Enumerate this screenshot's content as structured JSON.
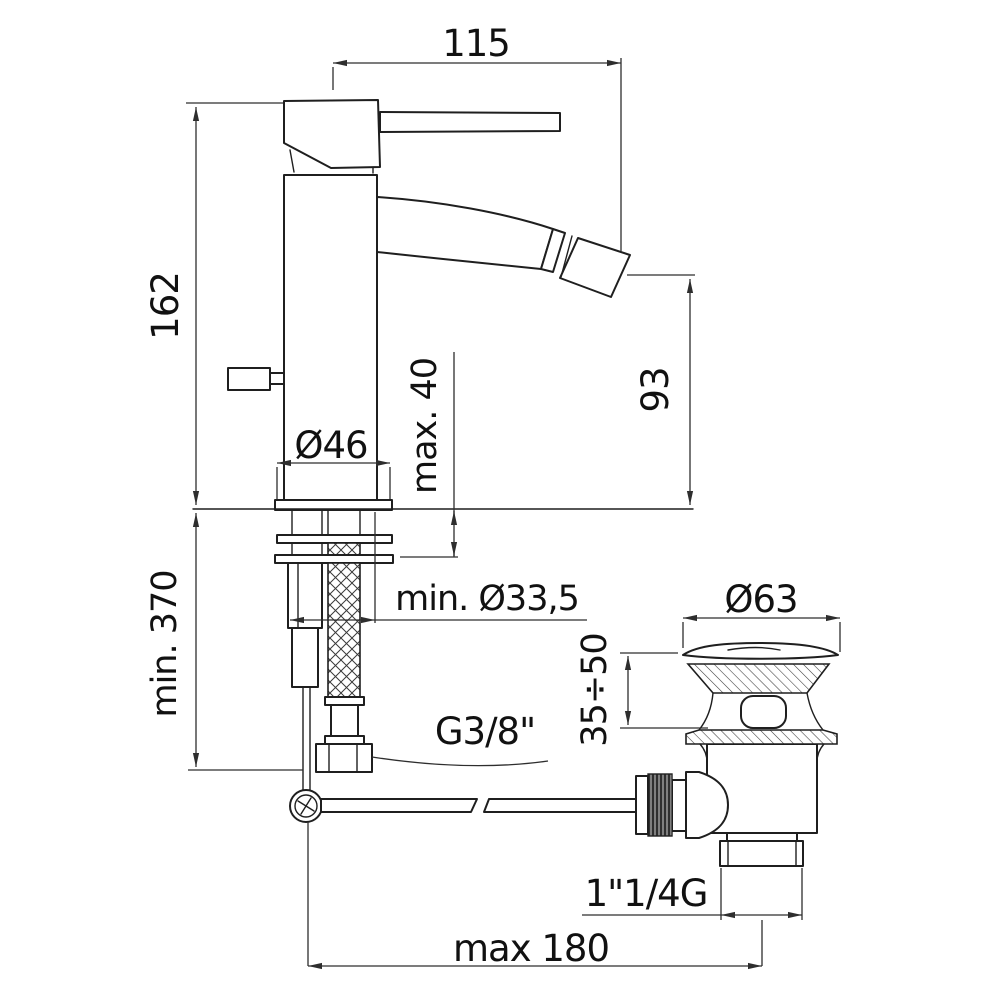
{
  "drawing": {
    "type": "technical-dimension-drawing",
    "subject": "single-lever bidet mixer with pop-up waste drain",
    "background_color": "#ffffff",
    "line_color": "#1f1f1f",
    "dimension_line_color": "#2e2e2e",
    "dims": {
      "spout_reach": "115",
      "body_height": "162",
      "spout_height": "93",
      "base_diameter": "Ø46",
      "deck_thickness": "max. 40",
      "hose_length": "min. 370",
      "hole_diameter": "min. Ø33,5",
      "hose_thread": "G3/8\"",
      "waste_cap_diameter": "Ø63",
      "waste_clamp_range": "35÷50",
      "waste_thread": "1\"1/4G",
      "rod_to_waste_distance": "max 180"
    }
  }
}
